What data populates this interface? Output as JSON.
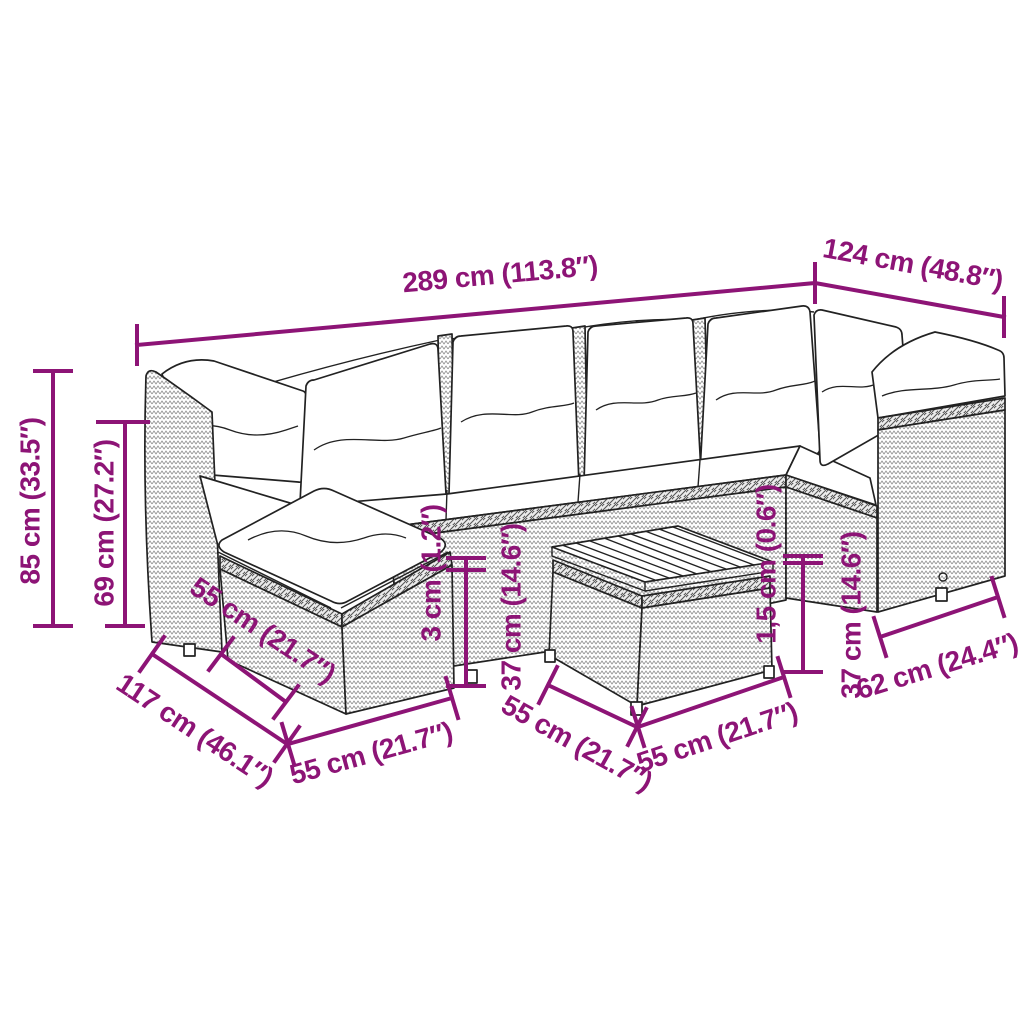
{
  "colors": {
    "accent": "#8D1476",
    "ink": "#222222"
  },
  "labels": {
    "overall_length": "289 cm (113.8″)",
    "return_depth": "124 cm (48.8″)",
    "total_height": "85 cm (33.5″)",
    "backrest_height": "69 cm (27.2″)",
    "ottoman_depth": "55 cm (21.7″)",
    "left_total_depth": "117 cm (46.1″)",
    "ottoman_width": "55 cm (21.7″)",
    "seat_cushion_thickness": "3 cm (1.2″)",
    "seat_height": "37 cm (14.6″)",
    "table_depth": "55 cm (21.7″)",
    "table_width": "55 cm (21.7″)",
    "tabletop_thickness": "1,5 cm (0.6″)",
    "table_height": "37 cm (14.6″)",
    "armrest_depth": "62 cm (24.4″)"
  }
}
